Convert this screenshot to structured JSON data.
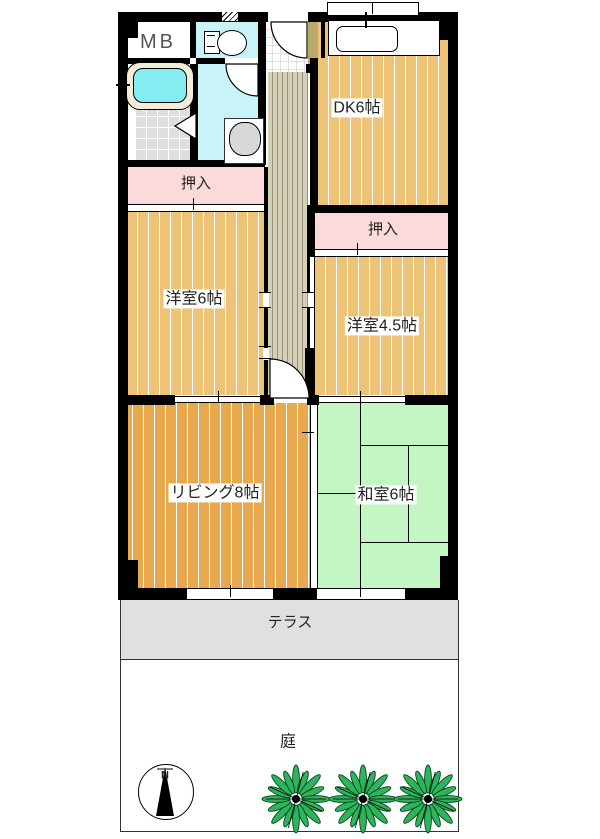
{
  "floorplan": {
    "labels": {
      "mb": "MB",
      "dk": "DK6帖",
      "closet_north": "押入",
      "closet_east": "押入",
      "western_6": "洋室6帖",
      "western_45": "洋室4.5帖",
      "living": "リビング8帖",
      "japanese_6": "和室6帖",
      "terrace": "テラス",
      "garden": "庭",
      "compass_north": "N"
    },
    "colors": {
      "wood": "#ECC377",
      "living_wood": "#E8A84E",
      "tatami": "#C4F6C4",
      "closet_pink": "#FADADA",
      "water_cyan": "#C9F3F7",
      "tub_water": "#85EDF1",
      "corridor_tan": "#D4D0B8",
      "corridor_line": "#96917A",
      "step_tan": "#B9A96B",
      "tile_gray": "#DEDEDE",
      "terrace_gray": "#E0E0E0",
      "tree_green": "#2FB45C",
      "wall": "#000000"
    }
  }
}
